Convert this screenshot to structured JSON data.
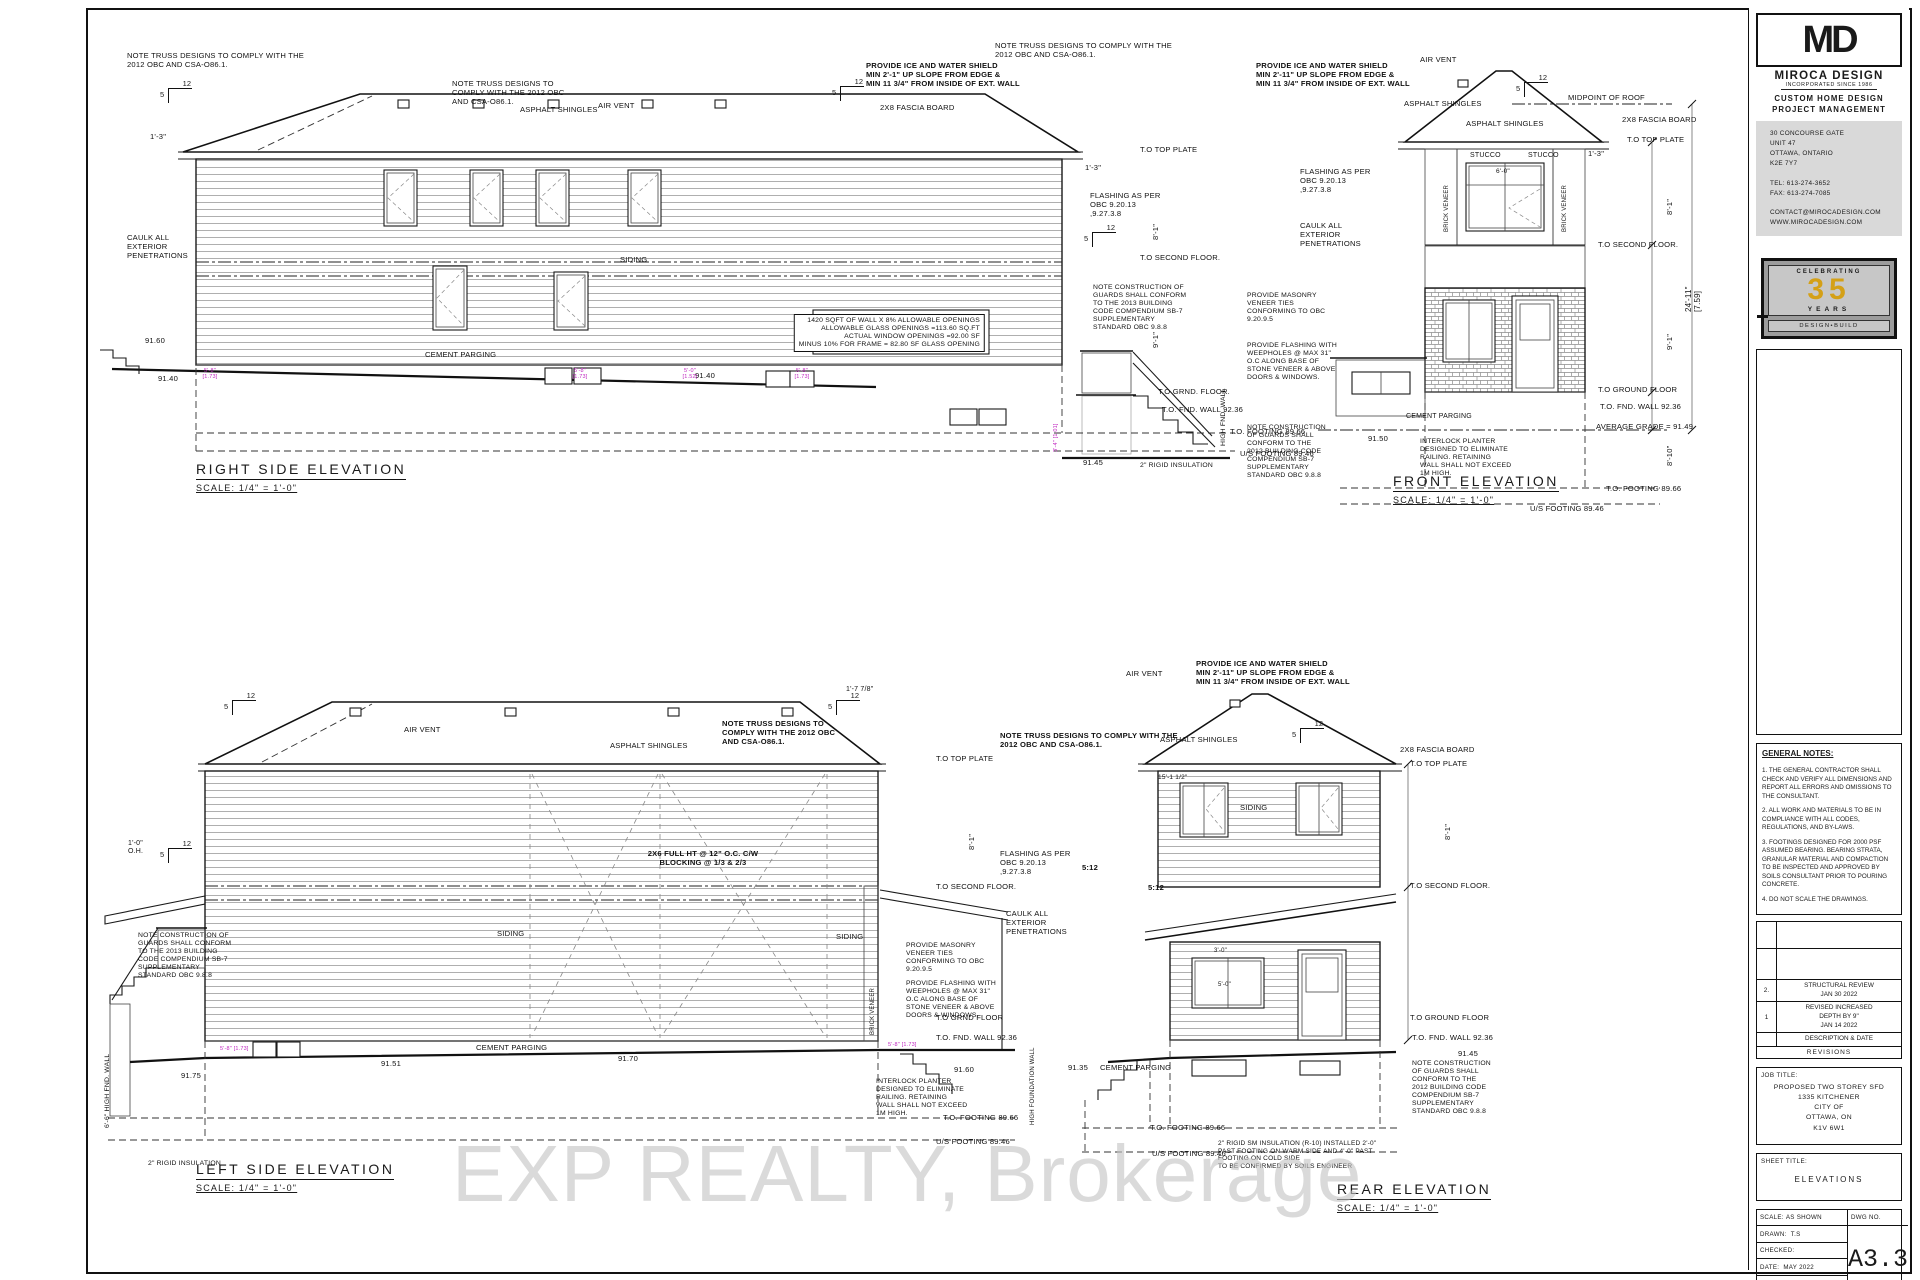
{
  "title_block": {
    "logo": "MD",
    "company": "MIROCA DESIGN",
    "incorporated": "INCORPORATED SINCE 1986",
    "service1": "CUSTOM HOME DESIGN",
    "service2": "PROJECT MANAGEMENT",
    "address_lines": [
      "30 CONCOURSE GATE",
      "UNIT 47",
      "OTTAWA, ONTARIO",
      "K2E 7Y7",
      "",
      "TEL: 613-274-3652",
      "FAX: 613-274-7085",
      "",
      "CONTACT@MIROCADESIGN.COM",
      "WWW.MIROCADESIGN.COM"
    ],
    "badge": {
      "celebrating": "CELEBRATING",
      "years_num": "35",
      "years": "YEARS",
      "design_build": "DESIGN•BUILD",
      "accent": "#d4a017"
    }
  },
  "general_notes": {
    "title": "GENERAL NOTES:",
    "notes": [
      "1. THE GENERAL CONTRACTOR SHALL CHECK AND VERIFY ALL DIMENSIONS AND REPORT ALL ERRORS AND OMISSIONS TO THE CONSULTANT.",
      "2. ALL WORK AND MATERIALS TO BE IN COMPLIANCE WITH ALL CODES, REGULATIONS, AND BY-LAWS.",
      "3. FOOTINGS DESIGNED FOR 2000 PSF ASSUMED BEARING. BEARING STRATA, GRANULAR MATERIAL AND COMPACTION TO BE INSPECTED AND APPROVED BY SOILS CONSULTANT PRIOR TO POURING CONCRETE.",
      "4. DO NOT SCALE THE DRAWINGS."
    ]
  },
  "revisions": {
    "rows": [
      {
        "no": "2.",
        "desc": "STRUCTURAL REVIEW\nJAN 30 2022"
      },
      {
        "no": "1",
        "desc": "REVISED INCREASED\nDEPTH BY 9\"\nJAN 14 2022"
      }
    ],
    "desc_date": "DESCRIPTION & DATE",
    "footer": "REVISIONS"
  },
  "job": {
    "label": "JOB TITLE:",
    "lines": [
      "PROPOSED TWO STOREY SFD",
      "1335 KITCHENER",
      "CITY OF",
      "OTTAWA, ON",
      "K1V 6W1"
    ]
  },
  "sheet_title": {
    "label": "SHEET TITLE:",
    "value": "ELEVATIONS"
  },
  "info": {
    "scale_label": "SCALE:",
    "scale": "AS SHOWN",
    "dwg_label": "DWG NO.",
    "drawn_label": "DRAWN:",
    "drawn": "T.S",
    "checked_label": "CHECKED:",
    "date_label": "DATE:",
    "date": "MAY 2022",
    "print_label": "PRINT DATE:",
    "number": "A3.3"
  },
  "drawings": {
    "right_side": {
      "title": "RIGHT SIDE ELEVATION",
      "scale": "SCALE: 1/4\" = 1'-0\""
    },
    "front": {
      "title": "FRONT ELEVATION",
      "scale": "SCALE: 1/4\" = 1'-0\""
    },
    "left_side": {
      "title": "LEFT SIDE ELEVATION",
      "scale": "SCALE: 1/4\" = 1'-0\""
    },
    "rear": {
      "title": "REAR ELEVATION",
      "scale": "SCALE: 1/4\" = 1'-0\""
    }
  },
  "watermark": "EXP REALTY, Brokerage",
  "colors": {
    "purple_dim": "#c026c0",
    "badge_gold": "#d4a017",
    "watermark_gray": "#c4c4c4"
  },
  "slope_marks": [
    {
      "x": 168,
      "y": 88,
      "run": "12",
      "rise": "5"
    },
    {
      "x": 840,
      "y": 86,
      "run": "12",
      "rise": "5"
    },
    {
      "x": 1092,
      "y": 232,
      "run": "12",
      "rise": "5"
    },
    {
      "x": 1524,
      "y": 82,
      "run": "12",
      "rise": "5"
    },
    {
      "x": 232,
      "y": 700,
      "run": "12",
      "rise": "5"
    },
    {
      "x": 836,
      "y": 700,
      "run": "12",
      "rise": "5"
    },
    {
      "x": 168,
      "y": 848,
      "run": "12",
      "rise": "5"
    },
    {
      "x": 1300,
      "y": 728,
      "run": "12",
      "rise": "5"
    }
  ],
  "annotations": [
    {
      "t": "NOTE TRUSS DESIGNS TO COMPLY WITH THE\n2012 OBC AND CSA-O86.1.",
      "x": 127,
      "y": 52
    },
    {
      "t": "NOTE TRUSS DESIGNS TO\nCOMPLY WITH THE 2012 OBC\nAND CSA-O86.1.",
      "x": 452,
      "y": 80
    },
    {
      "t": "ASPHALT SHINGLES",
      "x": 520,
      "y": 106
    },
    {
      "t": "AIR VENT",
      "x": 598,
      "y": 102
    },
    {
      "t": "PROVIDE ICE AND WATER SHIELD\nMIN 2'-1\" UP SLOPE FROM EDGE &\nMIN 11 3/4\" FROM INSIDE OF EXT. WALL",
      "x": 866,
      "y": 62,
      "b": 1
    },
    {
      "t": "2X8 FASCIA BOARD",
      "x": 880,
      "y": 104
    },
    {
      "t": "1'-3\"",
      "x": 150,
      "y": 133
    },
    {
      "t": "CAULK ALL\nEXTERIOR\nPENETRATIONS",
      "x": 127,
      "y": 234
    },
    {
      "t": "1420 SQFT OF WALL X 8% ALLOWABLE OPENINGS\nALLOWABLE GLASS OPENINGS =113.60 SQ.FT\nACTUAL WINDOW OPENINGS =92.00 SF\nMINUS 10% FOR FRAME = 82.80 SF GLASS OPENING",
      "x": 985,
      "y": 314,
      "fs": 6.8,
      "al": "r",
      "ta": "right"
    },
    {
      "t": "SIDING",
      "x": 620,
      "y": 256
    },
    {
      "t": "CEMENT PARGING",
      "x": 425,
      "y": 351
    },
    {
      "t": "91.60",
      "x": 145,
      "y": 337
    },
    {
      "t": "91.40",
      "x": 158,
      "y": 375
    },
    {
      "t": "91.40",
      "x": 695,
      "y": 372
    },
    {
      "t": "91.45",
      "x": 1083,
      "y": 459
    },
    {
      "t": "5'-8\"\n[1.73]",
      "x": 210,
      "y": 368,
      "col": "p",
      "fs": 5.5,
      "al": "c",
      "ta": "center"
    },
    {
      "t": "5'-8\"\n[1.73]",
      "x": 580,
      "y": 368,
      "col": "p",
      "fs": 5.5,
      "al": "c",
      "ta": "center"
    },
    {
      "t": "5'-0\"\n[1.52]",
      "x": 690,
      "y": 368,
      "col": "p",
      "fs": 5.5,
      "al": "c",
      "ta": "center"
    },
    {
      "t": "5'-8\"\n[1.73]",
      "x": 802,
      "y": 368,
      "col": "p",
      "fs": 5.5,
      "al": "c",
      "ta": "center"
    },
    {
      "t": "3'-4\" [1.01]",
      "x": 1053,
      "y": 452,
      "col": "p",
      "fs": 5.5,
      "rot": 1
    },
    {
      "t": "T.O TOP PLATE",
      "x": 1140,
      "y": 146
    },
    {
      "t": "1'-3\"",
      "x": 1085,
      "y": 164
    },
    {
      "t": "FLASHING AS PER\nOBC 9.20.13\n,9.27.3.8",
      "x": 1090,
      "y": 192
    },
    {
      "t": "T.O SECOND FLOOR.",
      "x": 1140,
      "y": 254
    },
    {
      "t": "8'-1\"",
      "x": 1152,
      "y": 240,
      "rot": 1
    },
    {
      "t": "9'-1\"",
      "x": 1152,
      "y": 348,
      "rot": 1
    },
    {
      "t": "NOTE CONSTRUCTION OF\nGUARDS SHALL CONFORM\nTO THE 2013 BUILDING\nCODE COMPENDIUM SB-7\nSUPPLEMENTARY\nSTANDARD OBC 9.8.8",
      "x": 1093,
      "y": 284,
      "fs": 6.8
    },
    {
      "t": "T.O GRND. FLOOR.",
      "x": 1158,
      "y": 388
    },
    {
      "t": "T.O. FND. WALL 92.36",
      "x": 1162,
      "y": 406
    },
    {
      "t": "HIGH FND. WALL",
      "x": 1220,
      "y": 446,
      "rot": 1,
      "fs": 6.8
    },
    {
      "t": "T.O. FOOTING 89.66",
      "x": 1230,
      "y": 428
    },
    {
      "t": "U/S FOOTING 89.46",
      "x": 1240,
      "y": 450
    },
    {
      "t": "2\" RIGID INSULATION",
      "x": 1140,
      "y": 462,
      "fs": 6.8
    },
    {
      "t": "PROVIDE MASONRY\nVENEER TIES\nCONFORMING TO OBC\n9.20.9.5",
      "x": 1247,
      "y": 292,
      "fs": 6.8
    },
    {
      "t": "PROVIDE FLASHING WITH\nWEEPHOLES @ MAX 31\"\nO.C ALONG BASE OF\nSTONE VENEER & ABOVE\nDOORS & WINDOWS.",
      "x": 1247,
      "y": 342,
      "fs": 6.8
    },
    {
      "t": "NOTE TRUSS DESIGNS TO COMPLY WITH THE\n2012 OBC AND CSA-O86.1.",
      "x": 995,
      "y": 42
    },
    {
      "t": "AIR VENT",
      "x": 1420,
      "y": 56
    },
    {
      "t": "PROVIDE ICE AND WATER SHIELD\nMIN 2'-11\" UP SLOPE FROM EDGE &\nMIN 11 3/4\" FROM INSIDE OF EXT. WALL",
      "x": 1256,
      "y": 62,
      "b": 1
    },
    {
      "t": "ASPHALT SHINGLES",
      "x": 1404,
      "y": 100
    },
    {
      "t": "ASPHALT SHINGLES",
      "x": 1466,
      "y": 120
    },
    {
      "t": "MIDPOINT OF ROOF",
      "x": 1568,
      "y": 94
    },
    {
      "t": "2X8 FASCIA BOARD",
      "x": 1622,
      "y": 116
    },
    {
      "t": "T.O TOP PLATE",
      "x": 1627,
      "y": 136
    },
    {
      "t": "1'-3\"",
      "x": 1588,
      "y": 150
    },
    {
      "t": "STUCCO",
      "x": 1470,
      "y": 152,
      "fs": 7
    },
    {
      "t": "STUCCO",
      "x": 1528,
      "y": 152,
      "fs": 7
    },
    {
      "t": "BRICK VENEER",
      "x": 1444,
      "y": 232,
      "rot": 1,
      "fs": 6
    },
    {
      "t": "BRICK VENEER",
      "x": 1562,
      "y": 232,
      "rot": 1,
      "fs": 6
    },
    {
      "t": "6'-0\"",
      "x": 1496,
      "y": 168,
      "fs": 6.5
    },
    {
      "t": "FLASHING AS PER\nOBC 9.20.13\n,9.27.3.8",
      "x": 1300,
      "y": 168
    },
    {
      "t": "CAULK ALL\nEXTERIOR\nPENETRATIONS",
      "x": 1300,
      "y": 222
    },
    {
      "t": "T.O SECOND FLOOR.",
      "x": 1598,
      "y": 241
    },
    {
      "t": "8'-1\"",
      "x": 1666,
      "y": 215,
      "rot": 1
    },
    {
      "t": "24'-11\"\n[7.59]",
      "x": 1684,
      "y": 312,
      "rot": 1,
      "fs": 8
    },
    {
      "t": "9'-1\"",
      "x": 1666,
      "y": 350,
      "rot": 1
    },
    {
      "t": "T.O GROUND FLOOR",
      "x": 1598,
      "y": 386
    },
    {
      "t": "T.O. FND. WALL 92.36",
      "x": 1600,
      "y": 403
    },
    {
      "t": "AVERAGE GRADE = 91.49",
      "x": 1596,
      "y": 423
    },
    {
      "t": "8'-10\"",
      "x": 1666,
      "y": 466,
      "rot": 1
    },
    {
      "t": "CEMENT PARGING",
      "x": 1406,
      "y": 413,
      "fs": 7
    },
    {
      "t": "91.50",
      "x": 1368,
      "y": 435
    },
    {
      "t": "INTERLOCK PLANTER\nDESIGNED TO ELIMINATE\nRAILING. RETAINING\nWALL SHALL NOT EXCEED\n1M HIGH.",
      "x": 1420,
      "y": 438,
      "fs": 6.8
    },
    {
      "t": "NOTE CONSTRUCTION\nOF GUARDS SHALL\nCONFORM TO THE\n2012 BUILDING CODE\nCOMPENDIUM SB-7\nSUPPLEMENTARY\nSTANDARD OBC 9.8.8",
      "x": 1247,
      "y": 424,
      "fs": 6.8
    },
    {
      "t": "T.O. FOOTING 89.66",
      "x": 1606,
      "y": 485
    },
    {
      "t": "U/S FOOTING 89.46",
      "x": 1530,
      "y": 505
    },
    {
      "t": "NOTE TRUSS DESIGNS TO\nCOMPLY WITH THE 2012 OBC\nAND CSA-O86.1.",
      "x": 722,
      "y": 720,
      "b": 1
    },
    {
      "t": "NOTE TRUSS DESIGNS TO COMPLY WITH THE\n2012 OBC AND CSA-O86.1.",
      "x": 1000,
      "y": 732,
      "b": 1
    },
    {
      "t": "AIR VENT",
      "x": 404,
      "y": 726
    },
    {
      "t": "ASPHALT SHINGLES",
      "x": 610,
      "y": 742
    },
    {
      "t": "1'-7 7/8\"",
      "x": 846,
      "y": 686,
      "fs": 7
    },
    {
      "t": "1'-0\"\nO.H.",
      "x": 128,
      "y": 840,
      "fs": 7
    },
    {
      "t": "T.O TOP PLATE",
      "x": 936,
      "y": 755
    },
    {
      "t": "8'-1\"",
      "x": 968,
      "y": 850,
      "rot": 1
    },
    {
      "t": "2X6 FULL HT @ 12\" O.C. C/W\nBLOCKING @ 1/3 & 2/3",
      "x": 703,
      "y": 850,
      "b": 1,
      "al": "c",
      "ta": "center"
    },
    {
      "t": "T.O SECOND FLOOR.",
      "x": 936,
      "y": 883
    },
    {
      "t": "FLASHING AS PER\nOBC 9.20.13\n,9.27.3.8",
      "x": 1000,
      "y": 850
    },
    {
      "t": "CAULK ALL\nEXTERIOR\nPENETRATIONS",
      "x": 1006,
      "y": 910
    },
    {
      "t": "SIDING",
      "x": 497,
      "y": 930
    },
    {
      "t": "SIDING",
      "x": 836,
      "y": 933
    },
    {
      "t": "NOTE CONSTRUCTION OF\nGUARDS SHALL CONFORM\nTO THE 2013 BUILDING\nCODE COMPENDIUM SB-7\nSUPPLEMENTARY\nSTANDARD OBC 9.8.8",
      "x": 138,
      "y": 932,
      "fs": 6.8
    },
    {
      "t": "PROVIDE MASONRY\nVENEER TIES\nCONFORMING TO OBC\n9.20.9.5",
      "x": 906,
      "y": 942,
      "fs": 6.8
    },
    {
      "t": "PROVIDE FLASHING WITH\nWEEPHOLES @ MAX 31\"\nO.C ALONG BASE OF\nSTONE VENEER & ABOVE\nDOORS & WINDOWS.",
      "x": 906,
      "y": 980,
      "fs": 6.8
    },
    {
      "t": "BRICK VENEER",
      "x": 870,
      "y": 1035,
      "rot": 1,
      "fs": 6
    },
    {
      "t": "T.O GRND FLOOR",
      "x": 936,
      "y": 1014
    },
    {
      "t": "T.O. FND. WALL 92.36",
      "x": 936,
      "y": 1034
    },
    {
      "t": "CEMENT PARGING",
      "x": 476,
      "y": 1044
    },
    {
      "t": "91.51",
      "x": 381,
      "y": 1060
    },
    {
      "t": "91.70",
      "x": 618,
      "y": 1055
    },
    {
      "t": "91.75",
      "x": 181,
      "y": 1072
    },
    {
      "t": "91.60",
      "x": 954,
      "y": 1066
    },
    {
      "t": "INTERLOCK PLANTER\nDESIGNED TO ELIMINATE\nRAILING. RETAINING\nWALL SHALL NOT EXCEED\n1M HIGH.",
      "x": 876,
      "y": 1078,
      "fs": 6.8
    },
    {
      "t": "6'-6\" HIGH FND. WALL",
      "x": 104,
      "y": 1128,
      "rot": 1,
      "fs": 6.8
    },
    {
      "t": "2\" RIGID INSULATION",
      "x": 148,
      "y": 1160,
      "fs": 6.8
    },
    {
      "t": "T.O. FOOTING 89.66",
      "x": 943,
      "y": 1114
    },
    {
      "t": "U/S FOOTING 89.46",
      "x": 936,
      "y": 1138
    },
    {
      "t": "HIGH FOUNDATION WALL",
      "x": 1030,
      "y": 1125,
      "rot": 1,
      "fs": 6
    },
    {
      "t": "5'-8\" [1.73]",
      "x": 220,
      "y": 1046,
      "col": "p",
      "fs": 5.5
    },
    {
      "t": "5'-8\" [1.73]",
      "x": 888,
      "y": 1042,
      "col": "p",
      "fs": 5.5
    },
    {
      "t": "AIR VENT",
      "x": 1126,
      "y": 670
    },
    {
      "t": "PROVIDE ICE AND WATER SHIELD\nMIN 2'-11\" UP SLOPE FROM EDGE &\nMIN 11 3/4\" FROM INSIDE OF EXT. WALL",
      "x": 1196,
      "y": 660,
      "b": 1
    },
    {
      "t": "ASPHALT SHINGLES",
      "x": 1160,
      "y": 736
    },
    {
      "t": "2X8 FASCIA BOARD",
      "x": 1400,
      "y": 746
    },
    {
      "t": "T.O TOP PLATE",
      "x": 1410,
      "y": 760
    },
    {
      "t": "15'-1 1/2\"",
      "x": 1158,
      "y": 774,
      "fs": 6.5
    },
    {
      "t": "SIDING",
      "x": 1240,
      "y": 804
    },
    {
      "t": "8'-1\"",
      "x": 1444,
      "y": 840,
      "rot": 1
    },
    {
      "t": "T.O SECOND FLOOR.",
      "x": 1410,
      "y": 882
    },
    {
      "t": "5:12",
      "x": 1082,
      "y": 864,
      "b": 1
    },
    {
      "t": "5:12",
      "x": 1148,
      "y": 884,
      "b": 1
    },
    {
      "t": "3'-0\"",
      "x": 1214,
      "y": 948,
      "fs": 6
    },
    {
      "t": "5'-0\"",
      "x": 1218,
      "y": 982,
      "fs": 6
    },
    {
      "t": "T.O GROUND FLOOR",
      "x": 1410,
      "y": 1014
    },
    {
      "t": "T.O. FND. WALL 92.36",
      "x": 1412,
      "y": 1034
    },
    {
      "t": "NOTE CONSTRUCTION\nOF GUARDS SHALL\nCONFORM TO THE\n2012 BUILDING CODE\nCOMPENDIUM SB-7\nSUPPLEMENTARY\nSTANDARD OBC 9.8.8",
      "x": 1412,
      "y": 1060,
      "fs": 6.8
    },
    {
      "t": "91.45",
      "x": 1458,
      "y": 1050
    },
    {
      "t": "91.35",
      "x": 1068,
      "y": 1064
    },
    {
      "t": "CEMENT PARGING",
      "x": 1100,
      "y": 1064
    },
    {
      "t": "T.O. FOOTING 89.66",
      "x": 1150,
      "y": 1124
    },
    {
      "t": "U/S FOOTING 89.46",
      "x": 1152,
      "y": 1150
    },
    {
      "t": "2\" RIGID SM INSULATION (R-10) INSTALLED 2'-0\"\nPAST FOOTING ON WARM SIDE AND 4'-0\" PAST\nFOOTING ON COLD SIDE\nTO BE CONFIRMED BY SOILS ENGINEER",
      "x": 1218,
      "y": 1140,
      "fs": 6.5
    }
  ]
}
